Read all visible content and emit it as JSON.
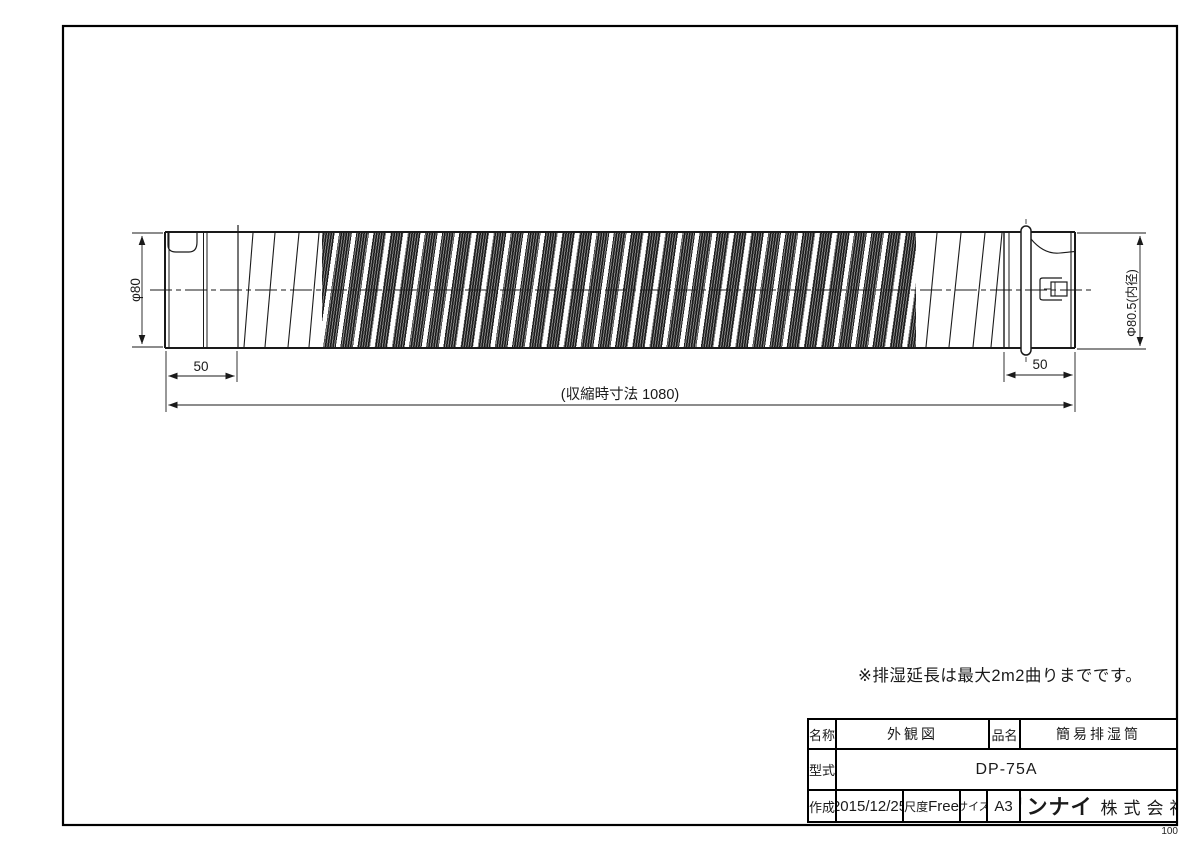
{
  "drawing": {
    "dim_diameter_left": "φ80",
    "dim_diameter_right": "Φ80.5(内径)",
    "dim_left_end": "50",
    "dim_right_end": "50",
    "dim_overall": "(収縮時寸法  1080)",
    "note": "※排湿延長は最大2m2曲りまでです。"
  },
  "title_block": {
    "name_label": "名称",
    "name_value": "外観図",
    "product_label": "品名",
    "product_value": "簡易排湿筒",
    "model_label": "型式",
    "model_value": "DP-75A",
    "created_label": "作成",
    "created_value": "2015/12/25",
    "scale_label": "尺度",
    "scale_value": "Free",
    "size_label": "サイズ",
    "size_value": "A3",
    "company_brand": "リンナイ",
    "company_suffix": "株式会社"
  },
  "footer": {
    "sheet_number": "100"
  },
  "colors": {
    "line": "#1a1a1a",
    "paper": "#ffffff"
  }
}
